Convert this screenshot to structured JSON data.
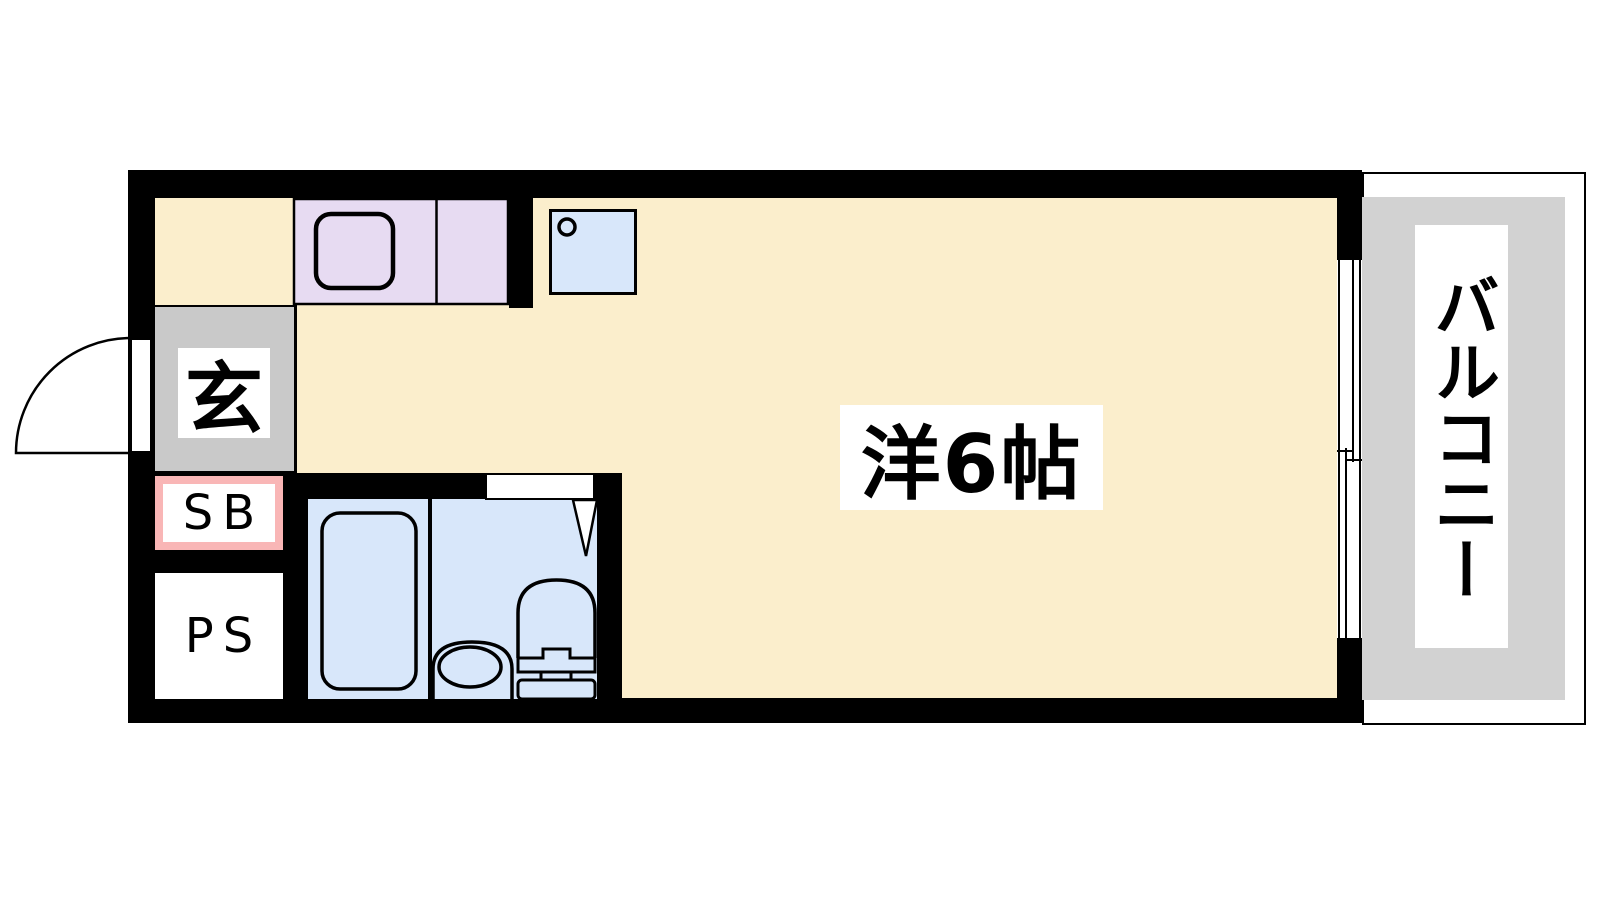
{
  "colors": {
    "wall": "#000000",
    "floor": "#fbeecc",
    "counter": "#e7dbf2",
    "water": "#d8e7fa",
    "entry_gray": "#c9c9c9",
    "balcony_gray": "#d2d2d2",
    "sb_pink": "#f9b6b6",
    "label_bg": "#ffffff",
    "line": "#000000"
  },
  "labels": {
    "entrance": "玄",
    "shoe_box": "SB",
    "pipe_space": "PS",
    "main_room": "洋6帖",
    "balcony": "バルコニー"
  }
}
